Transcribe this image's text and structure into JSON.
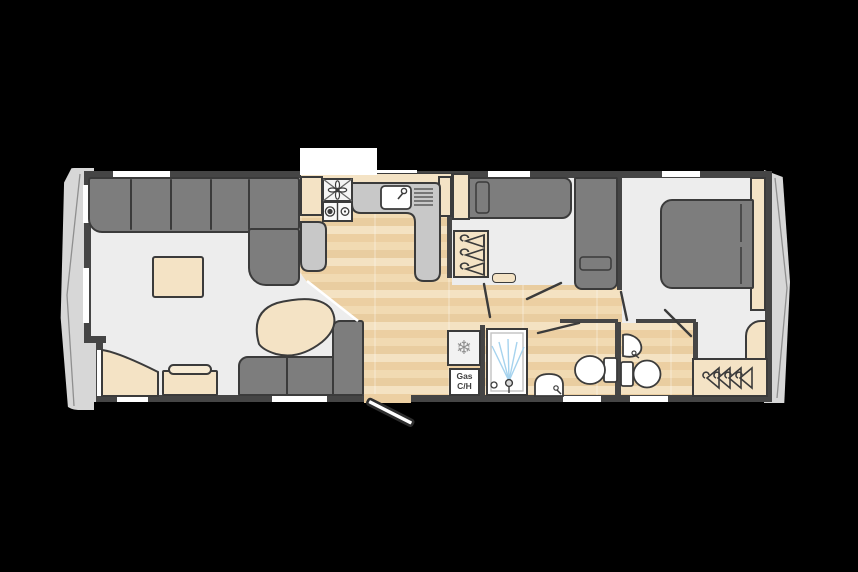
{
  "page": {
    "type": "static-caravan-floorplan",
    "background": "#000000"
  },
  "labels": {
    "gas_heater_line1": "Gas",
    "gas_heater_line2": "C/H"
  },
  "glyphs": {
    "fridge_snowflake": "❄"
  },
  "colors": {
    "wall": "#454545",
    "hull_end": "#d7d7d7",
    "room_floor": "#ededed",
    "wood_floor_light": "#f4e2c2",
    "wood_floor_dark": "#e9cda0",
    "upholstery_gray": "#7d7d7d",
    "furniture_beige": "#f4e3c5",
    "worktop_gray": "#c8c8c8",
    "outline": "#3b3b3b",
    "window_white": "#ffffff",
    "shower_spray_blue": "#a6d3ee"
  },
  "rooms": {
    "lounge": "lounge",
    "kitchen": "kitchen",
    "front_bedroom": "twin-bedroom",
    "shower_room": "shower-room",
    "ensuite": "ensuite-wc",
    "master_bedroom": "master-bedroom"
  },
  "fixtures": [
    "corner-sofa",
    "coffee-table",
    "occasional-table",
    "stool",
    "corner-seat",
    "sofa",
    "extractor-fan",
    "hob",
    "sink-drainer",
    "worktop",
    "fridge",
    "gas-central-heating",
    "wardrobe",
    "single-bed",
    "single-bed",
    "double-bed",
    "shower",
    "washbasin",
    "toilet",
    "washbasin",
    "toilet",
    "wardrobe-hangers",
    "entrance-door"
  ]
}
